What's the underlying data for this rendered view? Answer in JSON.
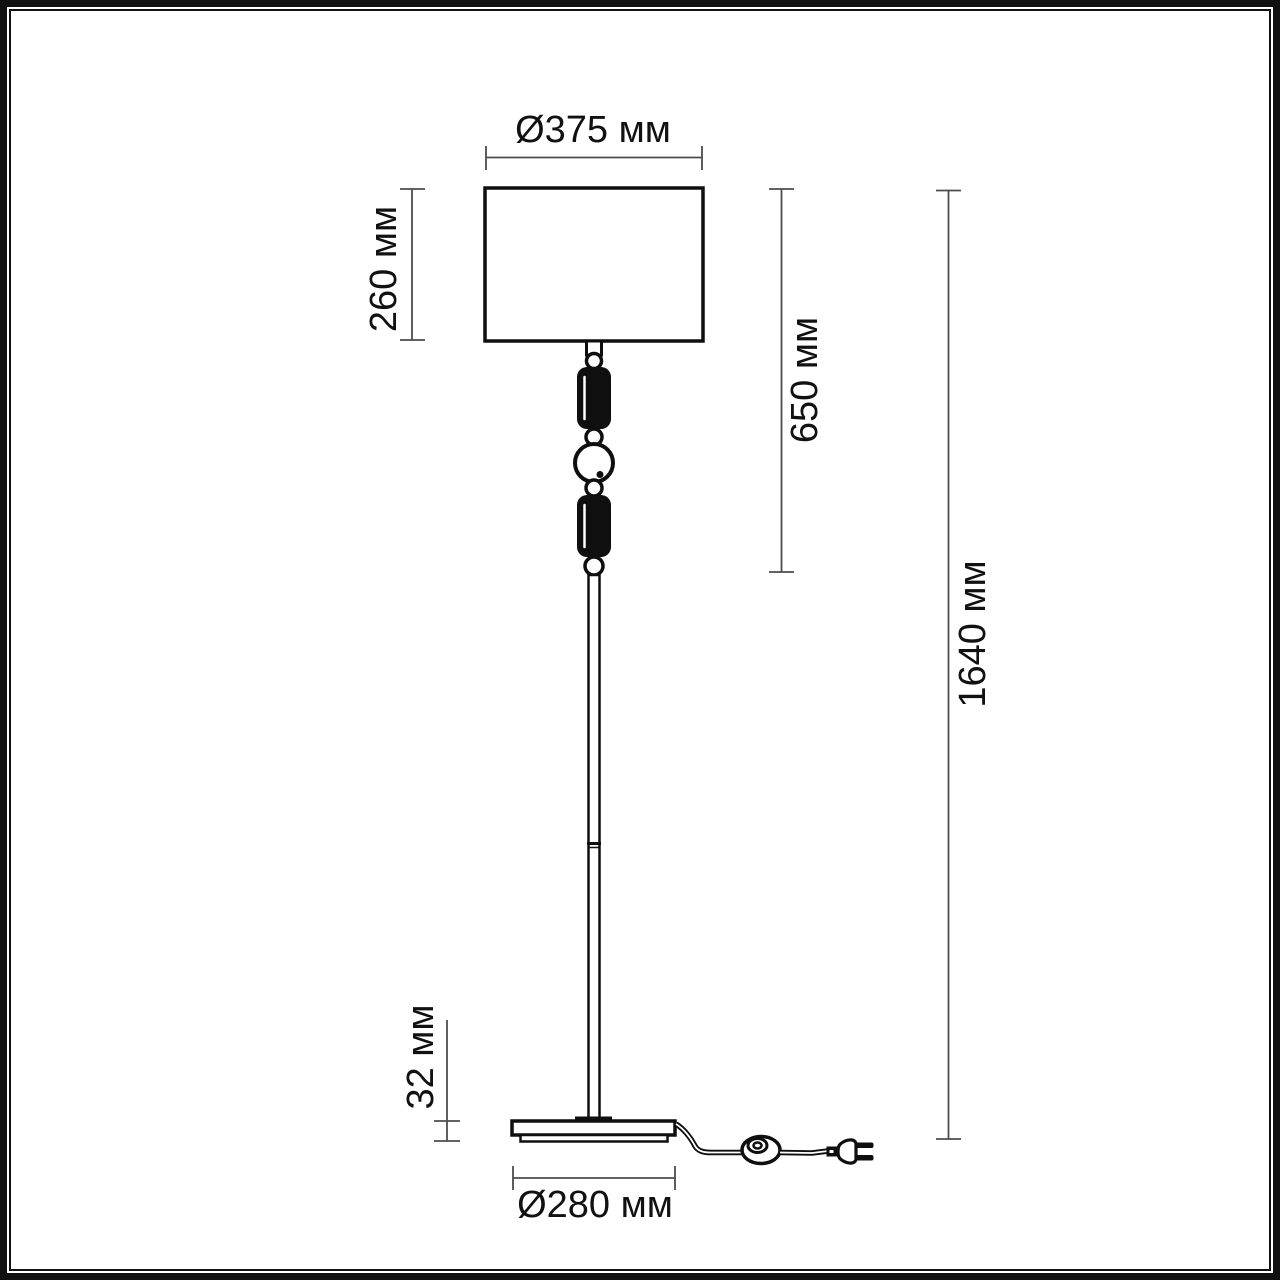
{
  "drawing": {
    "kind": "floor-lamp-dimensional-drawing",
    "background": "#ffffff",
    "frame_color": "#111111",
    "outline_color": "#0f0f0f",
    "dimension_line_color": "#4d4d4d",
    "labels": {
      "shade_diameter": "Ø375 мм",
      "shade_height": "260 мм",
      "upper_section_height": "650 мм",
      "total_height": "1640 мм",
      "base_thickness": "32 мм",
      "base_diameter": "Ø280 мм"
    }
  }
}
